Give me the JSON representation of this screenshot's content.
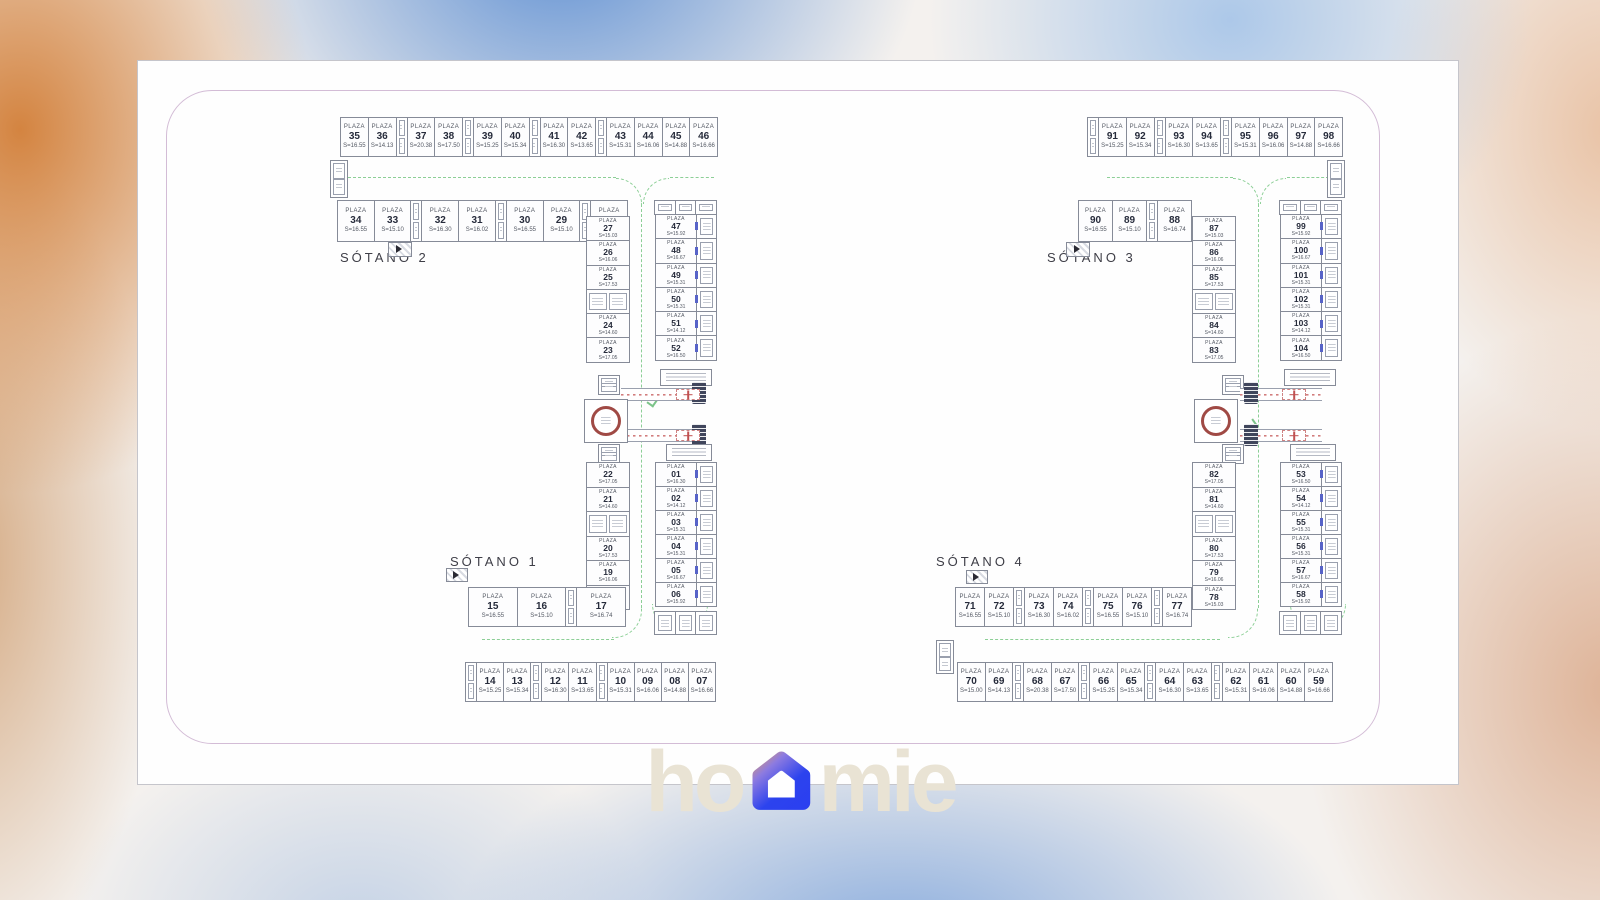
{
  "labels": {
    "plaza": "PLAZA"
  },
  "logo": {
    "left": "ho",
    "right": "mie"
  },
  "colors": {
    "card_border": "#d3bcd6",
    "lane_green": "#8ccf96",
    "ramp_red": "#c05050",
    "elevator_ring": "#a04a45",
    "door_blue": "#5763c8",
    "logo_beige": "#e9e3d4",
    "house_orange": "#f2a24c",
    "house_blue": "#2c43ee",
    "bg_orange": "#d27e37",
    "bg_blue": "#5086d0"
  },
  "plans": {
    "left": {
      "label_top": "SÓTANO 2",
      "label_bottom": "SÓTANO 1",
      "top_row": [
        {
          "n": "35",
          "a": "S=16.55"
        },
        {
          "n": "36",
          "a": "S=14.13"
        },
        {
          "t": "s"
        },
        {
          "n": "37",
          "a": "S=20.38"
        },
        {
          "n": "38",
          "a": "S=17.50"
        },
        {
          "t": "s"
        },
        {
          "n": "39",
          "a": "S=15.25"
        },
        {
          "n": "40",
          "a": "S=15.34"
        },
        {
          "t": "s"
        },
        {
          "n": "41",
          "a": "S=16.30"
        },
        {
          "n": "42",
          "a": "S=13.65"
        },
        {
          "t": "s"
        },
        {
          "n": "43",
          "a": "S=15.31"
        },
        {
          "n": "44",
          "a": "S=16.06"
        },
        {
          "n": "45",
          "a": "S=14.88"
        },
        {
          "n": "46",
          "a": "S=16.66"
        }
      ],
      "second_row": [
        {
          "n": "34",
          "a": "S=16.55"
        },
        {
          "n": "33",
          "a": "S=15.10"
        },
        {
          "t": "s"
        },
        {
          "n": "32",
          "a": "S=16.30"
        },
        {
          "n": "31",
          "a": "S=16.02"
        },
        {
          "t": "s"
        },
        {
          "n": "30",
          "a": "S=16.55"
        },
        {
          "n": "29",
          "a": "S=15.10"
        },
        {
          "t": "s"
        },
        {
          "n": "28",
          "a": "S=16.74"
        }
      ],
      "col_upper_left": [
        {
          "n": "27",
          "a": "S=15.03"
        },
        {
          "n": "26",
          "a": "S=16.06"
        },
        {
          "n": "25",
          "a": "S=17.53"
        },
        {
          "t": "s"
        },
        {
          "n": "24",
          "a": "S=14.60"
        },
        {
          "n": "23",
          "a": "S=17.05"
        }
      ],
      "col_upper_right": [
        {
          "n": "47",
          "a": "S=15.92"
        },
        {
          "n": "48",
          "a": "S=16.67"
        },
        {
          "n": "49",
          "a": "S=15.31"
        },
        {
          "n": "50",
          "a": "S=15.31"
        },
        {
          "n": "51",
          "a": "S=14.12"
        },
        {
          "n": "52",
          "a": "S=16.50"
        }
      ],
      "col_lower_left": [
        {
          "n": "22",
          "a": "S=17.05"
        },
        {
          "n": "21",
          "a": "S=14.60"
        },
        {
          "t": "s"
        },
        {
          "n": "20",
          "a": "S=17.53"
        },
        {
          "n": "19",
          "a": "S=16.06"
        },
        {
          "n": "18",
          "a": "S=15.03"
        }
      ],
      "col_lower_right": [
        {
          "n": "01",
          "a": "S=16.30"
        },
        {
          "n": "02",
          "a": "S=14.12"
        },
        {
          "n": "03",
          "a": "S=15.31"
        },
        {
          "n": "04",
          "a": "S=15.31"
        },
        {
          "n": "05",
          "a": "S=16.67"
        },
        {
          "n": "06",
          "a": "S=15.92"
        }
      ],
      "mid_row": [
        {
          "n": "15",
          "a": "S=16.55"
        },
        {
          "n": "16",
          "a": "S=15.10"
        },
        {
          "t": "s"
        },
        {
          "n": "17",
          "a": "S=16.74"
        }
      ],
      "bottom_row": [
        {
          "t": "s"
        },
        {
          "n": "14",
          "a": "S=15.25"
        },
        {
          "n": "13",
          "a": "S=15.34"
        },
        {
          "t": "s"
        },
        {
          "n": "12",
          "a": "S=16.30"
        },
        {
          "n": "11",
          "a": "S=13.65"
        },
        {
          "t": "s"
        },
        {
          "n": "10",
          "a": "S=15.31"
        },
        {
          "n": "09",
          "a": "S=16.06"
        },
        {
          "n": "08",
          "a": "S=14.88"
        },
        {
          "n": "07",
          "a": "S=16.66"
        }
      ]
    },
    "right": {
      "label_top": "SÓTANO 3",
      "label_bottom": "SÓTANO 4",
      "top_row": [
        {
          "t": "s"
        },
        {
          "n": "91",
          "a": "S=15.25"
        },
        {
          "n": "92",
          "a": "S=15.34"
        },
        {
          "t": "s"
        },
        {
          "n": "93",
          "a": "S=16.30"
        },
        {
          "n": "94",
          "a": "S=13.65"
        },
        {
          "t": "s"
        },
        {
          "n": "95",
          "a": "S=15.31"
        },
        {
          "n": "96",
          "a": "S=16.06"
        },
        {
          "n": "97",
          "a": "S=14.88"
        },
        {
          "n": "98",
          "a": "S=16.66"
        }
      ],
      "second_row": [
        {
          "n": "90",
          "a": "S=16.55"
        },
        {
          "n": "89",
          "a": "S=15.10"
        },
        {
          "t": "s"
        },
        {
          "n": "88",
          "a": "S=16.74"
        }
      ],
      "col_upper_left": [
        {
          "n": "87",
          "a": "S=15.03"
        },
        {
          "n": "86",
          "a": "S=16.06"
        },
        {
          "n": "85",
          "a": "S=17.53"
        },
        {
          "t": "s"
        },
        {
          "n": "84",
          "a": "S=14.60"
        },
        {
          "n": "83",
          "a": "S=17.05"
        }
      ],
      "col_upper_right": [
        {
          "n": "99",
          "a": "S=15.92"
        },
        {
          "n": "100",
          "a": "S=16.67"
        },
        {
          "n": "101",
          "a": "S=15.31"
        },
        {
          "n": "102",
          "a": "S=15.31"
        },
        {
          "n": "103",
          "a": "S=14.12"
        },
        {
          "n": "104",
          "a": "S=16.50"
        }
      ],
      "col_lower_left": [
        {
          "n": "82",
          "a": "S=17.05"
        },
        {
          "n": "81",
          "a": "S=14.60"
        },
        {
          "t": "s"
        },
        {
          "n": "80",
          "a": "S=17.53"
        },
        {
          "n": "79",
          "a": "S=16.06"
        },
        {
          "n": "78",
          "a": "S=15.03"
        }
      ],
      "col_lower_right": [
        {
          "n": "53",
          "a": "S=16.50"
        },
        {
          "n": "54",
          "a": "S=14.12"
        },
        {
          "n": "55",
          "a": "S=15.31"
        },
        {
          "n": "56",
          "a": "S=15.31"
        },
        {
          "n": "57",
          "a": "S=16.67"
        },
        {
          "n": "58",
          "a": "S=15.92"
        }
      ],
      "mid_row": [
        {
          "n": "71",
          "a": "S=16.55"
        },
        {
          "n": "72",
          "a": "S=15.10"
        },
        {
          "t": "s"
        },
        {
          "n": "73",
          "a": "S=16.30"
        },
        {
          "n": "74",
          "a": "S=16.02"
        },
        {
          "t": "s"
        },
        {
          "n": "75",
          "a": "S=16.55"
        },
        {
          "n": "76",
          "a": "S=15.10"
        },
        {
          "t": "s"
        },
        {
          "n": "77",
          "a": "S=16.74"
        }
      ],
      "bottom_row": [
        {
          "n": "70",
          "a": "S=15.00"
        },
        {
          "n": "69",
          "a": "S=14.13"
        },
        {
          "t": "s"
        },
        {
          "n": "68",
          "a": "S=20.38"
        },
        {
          "n": "67",
          "a": "S=17.50"
        },
        {
          "t": "s"
        },
        {
          "n": "66",
          "a": "S=15.25"
        },
        {
          "n": "65",
          "a": "S=15.34"
        },
        {
          "t": "s"
        },
        {
          "n": "64",
          "a": "S=16.30"
        },
        {
          "n": "63",
          "a": "S=13.65"
        },
        {
          "t": "s"
        },
        {
          "n": "62",
          "a": "S=15.31"
        },
        {
          "n": "61",
          "a": "S=16.06"
        },
        {
          "n": "60",
          "a": "S=14.88"
        },
        {
          "n": "59",
          "a": "S=16.66"
        }
      ]
    }
  }
}
